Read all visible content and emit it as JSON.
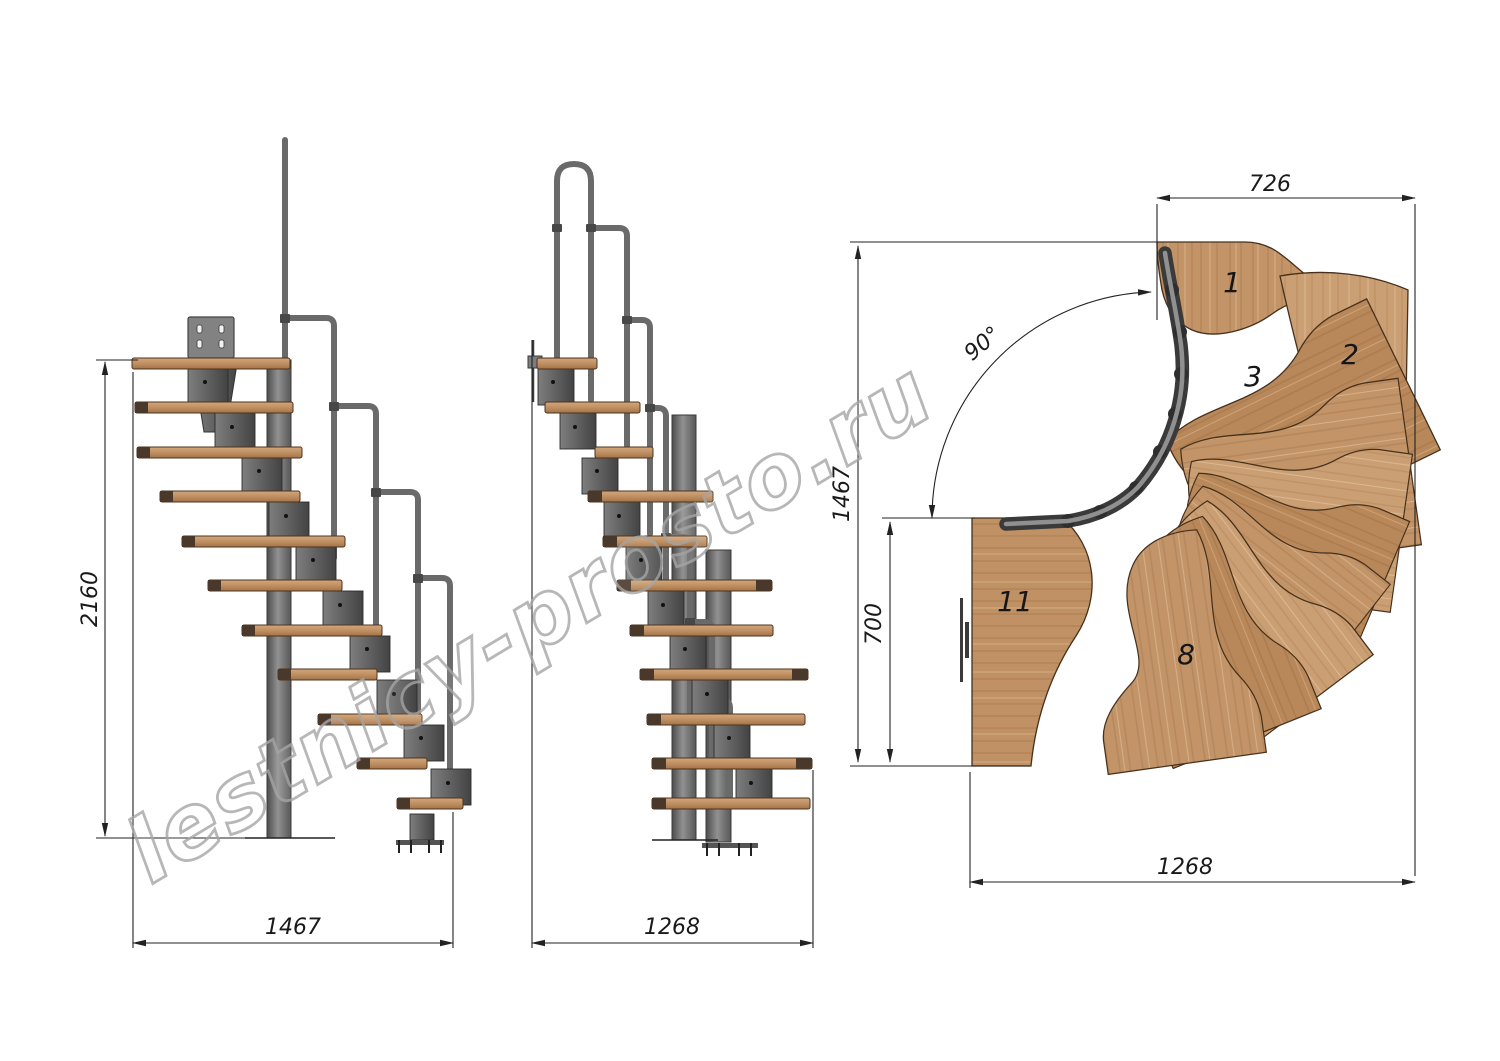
{
  "drawing": {
    "watermark": "lestnicy-prosto.ru",
    "views": {
      "front": {
        "label": "front elevation",
        "height_dim": "2160",
        "width_dim": "1467"
      },
      "side": {
        "label": "side elevation",
        "width_dim": "1268"
      },
      "plan": {
        "label": "plan view",
        "entry_width_dim": "726",
        "overall_depth_dim": "1467",
        "landing_depth_dim": "700",
        "overall_width_dim": "1268",
        "turn_angle": "90°",
        "tread_labels": [
          "1",
          "2",
          "3",
          "8",
          "11"
        ]
      }
    },
    "colors": {
      "wood": "#c29468",
      "wood_dark": "#a6784e",
      "metal": "#6d6d6d",
      "metal_dark": "#3d3d3d",
      "dimension_line": "#222222",
      "watermark_outline": "#a6a6a6",
      "background": "#ffffff"
    }
  }
}
